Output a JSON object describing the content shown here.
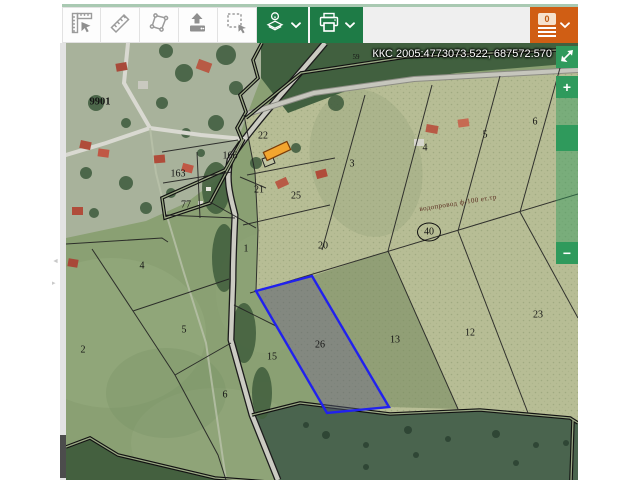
{
  "toolbar": {
    "tools": [
      {
        "id": "measure-coordinates",
        "icon": "corner-ruler-icon"
      },
      {
        "id": "measure-distance",
        "icon": "ruler-icon"
      },
      {
        "id": "measure-area",
        "icon": "polygon-icon"
      },
      {
        "id": "upload-data",
        "icon": "upload-icon"
      },
      {
        "id": "select-region",
        "icon": "selection-rectangle-icon"
      }
    ],
    "layers_button": {
      "icon": "layers-info-icon",
      "chevron": "chevron-down-icon"
    },
    "print_button": {
      "icon": "printer-icon",
      "chevron": "chevron-down-icon"
    },
    "cart_button": {
      "badge_count": "0",
      "icon": "order-list-icon",
      "chevron": "chevron-down-icon"
    }
  },
  "map": {
    "crs_readout": "ККС 2005:4773073.522, 687572.570",
    "pipeline_label": "водопровод ф-100 ет.тр",
    "point_marker": "40",
    "zoom_controls": {
      "zoom_in": "+",
      "zoom_out": "−"
    },
    "panel_toggle": {
      "collapse": "◄",
      "expand": "▸"
    },
    "labels": [
      {
        "text": "9901"
      },
      {
        "text": "166"
      },
      {
        "text": "163"
      },
      {
        "text": "77"
      },
      {
        "text": "22"
      },
      {
        "text": "21"
      },
      {
        "text": "25"
      },
      {
        "text": "3"
      },
      {
        "text": "4"
      },
      {
        "text": "5"
      },
      {
        "text": "6"
      },
      {
        "text": "1"
      },
      {
        "text": "20"
      },
      {
        "text": "2"
      },
      {
        "text": "4"
      },
      {
        "text": "5"
      },
      {
        "text": "6"
      },
      {
        "text": "15"
      },
      {
        "text": "26"
      },
      {
        "text": "13"
      },
      {
        "text": "12"
      },
      {
        "text": "23"
      },
      {
        "text": "59"
      }
    ],
    "selected_parcel": "26"
  },
  "colors": {
    "accent_green": "#1e7b46",
    "zoom_green": "#2f9a5c",
    "accent_orange": "#d05e14",
    "selection_blue": "#2121ee",
    "selected_building_orange": "#f2a52e",
    "header_line_green": "#a9c9b2"
  }
}
